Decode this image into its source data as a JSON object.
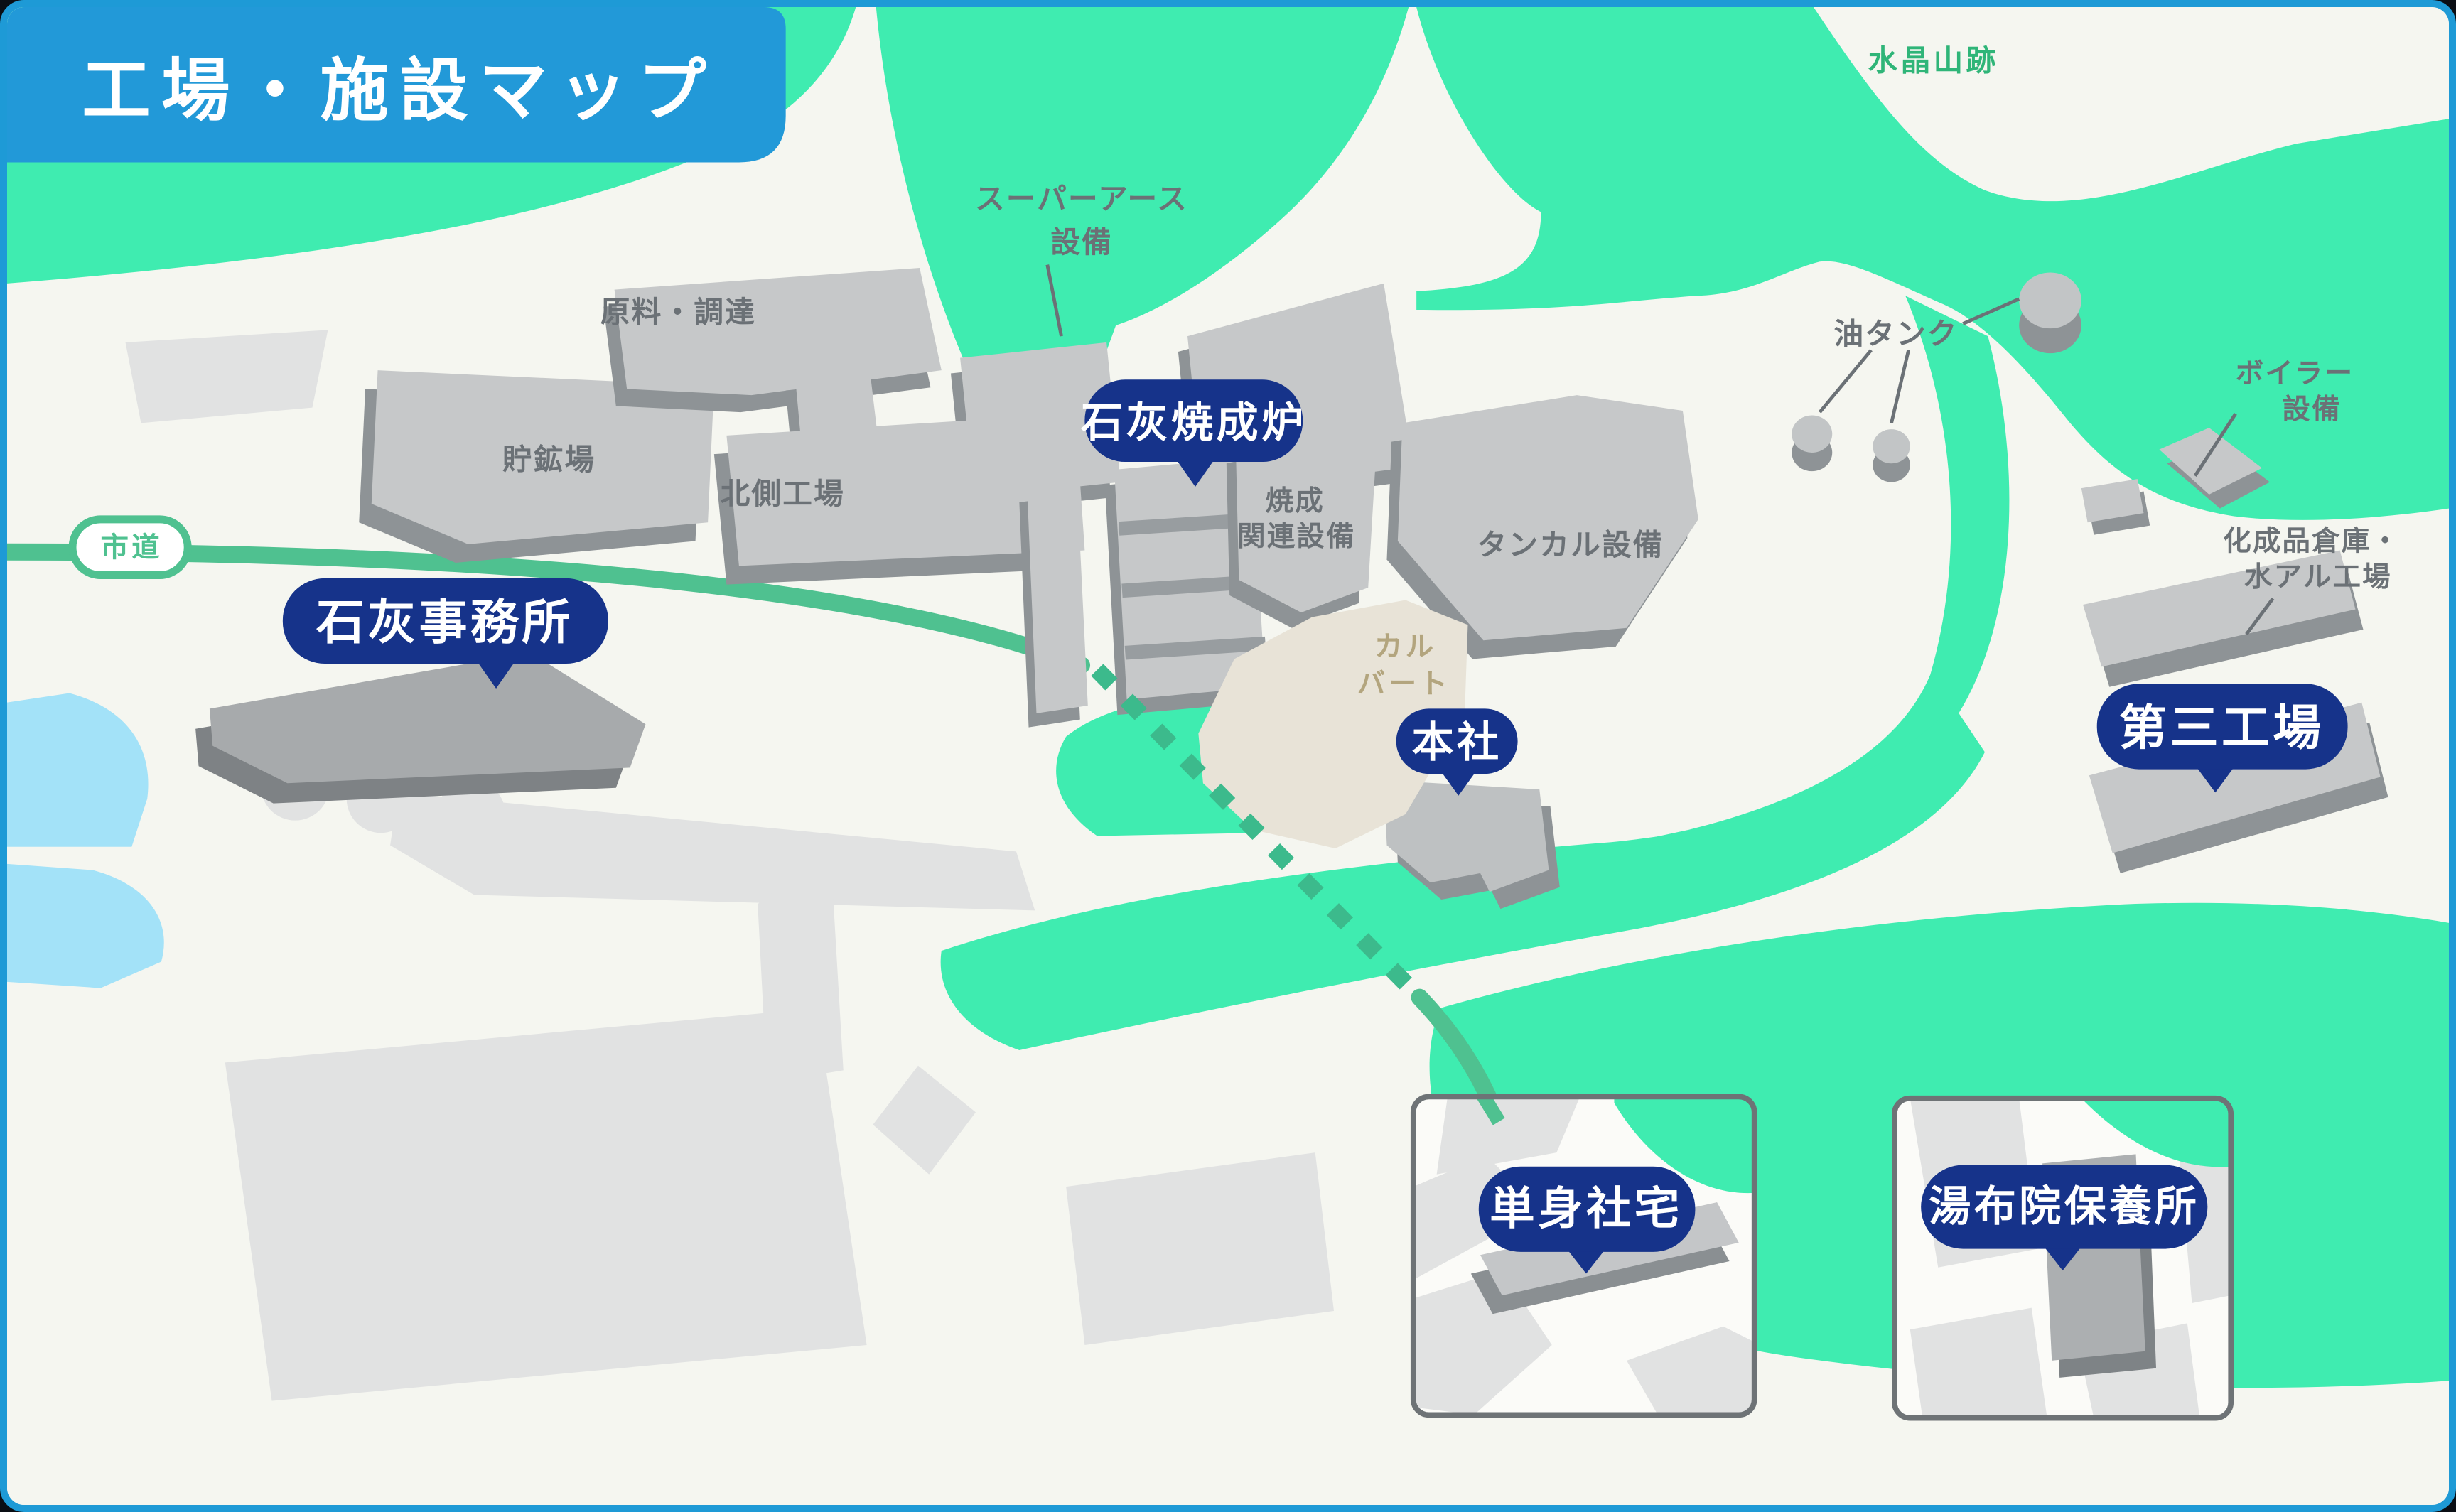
{
  "title": "工場・施設マップ",
  "colors": {
    "accent_blue": "#2299D8",
    "frame": "#1E9AD6",
    "badge_navy": "#16338A",
    "mint": "#3FECB0",
    "road": "#4FC190",
    "water": "#A3E2F8",
    "bg": "#F5F6F0",
    "gray_label": "#6B7176",
    "building_top": "#C6C8C9",
    "building_side": "#8E9396",
    "beige": "#E8E3D7",
    "beige_text": "#B3A57E",
    "green_text": "#2FB578"
  },
  "road": {
    "label": "市道"
  },
  "area_labels": {
    "mountain": "水晶山跡",
    "culvert_l1": "カル",
    "culvert_l2": "バート"
  },
  "badges": {
    "kiln": "石灰焼成炉",
    "office": "石灰事務所",
    "head_office": "本社",
    "third_plant": "第三工場",
    "dormitory": "単身社宅",
    "yufuin": "湯布院保養所"
  },
  "building_labels": {
    "super_earth_l1": "スーパーアース",
    "super_earth_l2": "設備",
    "raw_materials": "原料・調達",
    "ore_storage": "貯鉱場",
    "north_plant": "北側工場",
    "calcine_l1": "焼成",
    "calcine_l2": "関連設備",
    "tankal": "タンカル設備",
    "oil_tank": "油タンク",
    "boiler_l1": "ボイラー",
    "boiler_l2": "設備",
    "chem_l1": "化成品倉庫・",
    "chem_l2": "水アル工場"
  }
}
